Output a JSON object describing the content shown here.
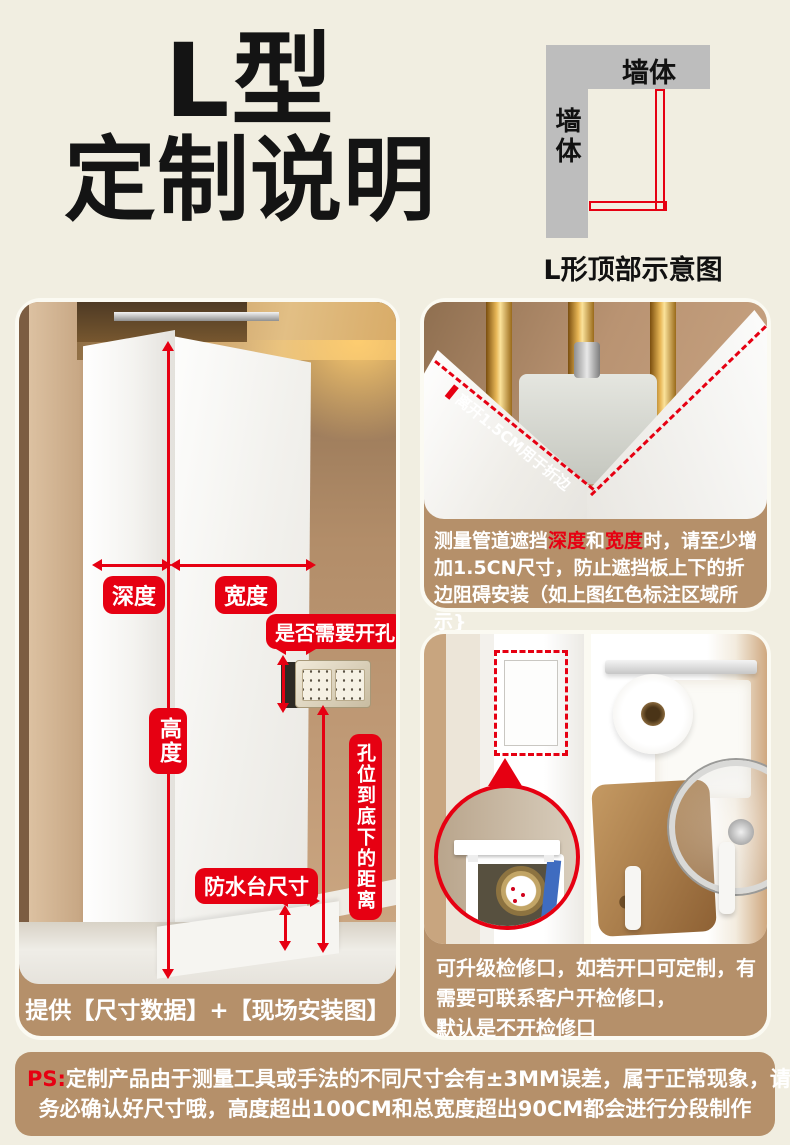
{
  "page": {
    "bg": "#f1eee1",
    "accent_red": "#e60012",
    "tan": "#b5906a"
  },
  "header": {
    "title_line1": "L型",
    "title_line2": "定制说明",
    "diagram": {
      "wall_top": "墙体",
      "wall_side": "墙体",
      "caption": "L形顶部示意图"
    }
  },
  "left_card": {
    "labels": {
      "depth": "深度",
      "width": "宽度",
      "height": "高度",
      "hole_question": "是否需要开孔",
      "waterproof": "防水台尺寸",
      "hole_distance": "孔位到底下的距离"
    },
    "caption": "提供【尺寸数据】+【现场安装图】"
  },
  "fold_card": {
    "photo_label": "离开1.5CM用于折边",
    "caption": {
      "seg1": "测量管道遮挡",
      "seg2": "深度",
      "seg3": "和",
      "seg4": "宽度",
      "seg5": "时，请至少增加1.5CN尺寸，防止遮挡板上下的折边阻碍安装（如上图红色标注区域所示}"
    }
  },
  "access_card": {
    "caption_line1": "可升级检修口，如若开口可定制，有",
    "caption_line2": "需要可联系客户开检修口，",
    "caption_line3": "默认是不开检修口"
  },
  "ps_note": {
    "prefix": "PS:",
    "line1": "定制产品由于测量工具或手法的不同尺寸会有±3MM误差，属于正常现象，请您",
    "line2": "务必确认好尺寸哦，高度超出100CM和总宽度超出90CM都会进行分段制作"
  }
}
